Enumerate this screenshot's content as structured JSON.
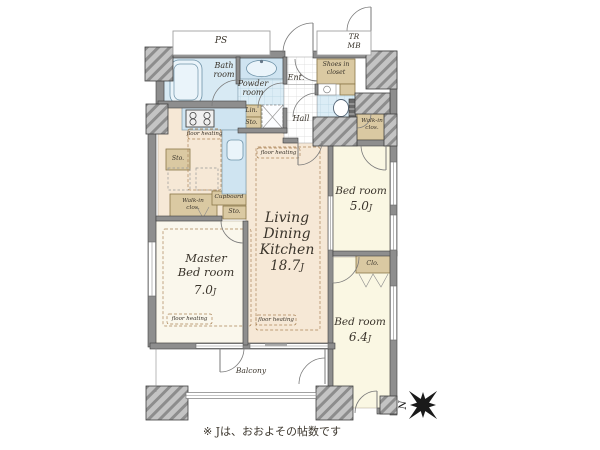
{
  "palette": {
    "ldk_floor": "#f6e8d6",
    "bedroom_floor": "#faf7e3",
    "master_floor": "#faf7ec",
    "closet_tan": "#dac9a2",
    "wet_blue": "#d8eaf4",
    "counter_blue": "#cfe4f1",
    "wall_gray": "#8e8e8e",
    "pillar_gray": "#c4c4c4",
    "text": "#3a342b"
  },
  "outside": {
    "ps": "PS",
    "trunk": "TR",
    "meter_box": "MB"
  },
  "rooms": {
    "ldk": {
      "line1": "Living",
      "line2": "Dining",
      "line3": "Kitchen",
      "size": "18.7",
      "unit": "J"
    },
    "master": {
      "line1": "Master",
      "line2": "Bed room",
      "size": "7.0",
      "unit": "J"
    },
    "bed5": {
      "name": "Bed room",
      "size": "5.0",
      "unit": "J"
    },
    "bed6": {
      "name": "Bed room",
      "size": "6.4",
      "unit": "J"
    },
    "bath": {
      "line1": "Bath",
      "line2": "room"
    },
    "powder": {
      "line1": "Powder",
      "line2": "room"
    },
    "entrance": "Ent.",
    "hall": "Hall",
    "balcony": "Balcony"
  },
  "storage": {
    "shoes_line1": "Shoes in",
    "shoes_line2": "closet",
    "walkin_line1": "Walk-in",
    "walkin_line2": "clos.",
    "linen": "Lin.",
    "sto": "Sto.",
    "cupboard": "Cupboard",
    "closet": "Clo."
  },
  "annotations": {
    "floor_heating": "floor heating",
    "note": "※ Jは、おおよその帖数です",
    "north": "N"
  }
}
